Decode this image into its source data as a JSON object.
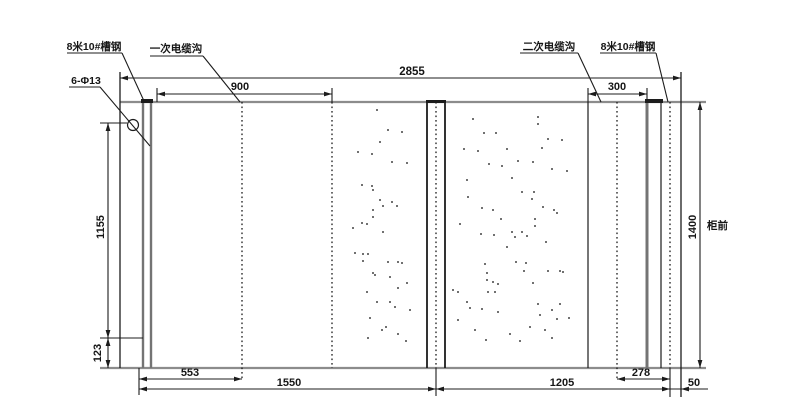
{
  "callouts": {
    "channel_steel_left": "8米10#槽钢",
    "primary_cable_trench": "一次电缆沟",
    "secondary_cable_trench": "二次电缆沟",
    "channel_steel_right": "8米10#槽钢",
    "bolt_holes": "6-Φ13",
    "cabinet_front": "柜前"
  },
  "dimensions": {
    "overall_width": "2855",
    "primary_trench_offset": "900",
    "secondary_trench_width": "300",
    "hole_span_vertical": "1155",
    "hole_to_bottom_edge": "123",
    "foundation_depth": "1400",
    "rail_to_primary_trench": "553",
    "left_section_width": "1550",
    "right_section_width": "1205",
    "trench_to_rail_right": "278",
    "rail_to_right_edge": "50"
  },
  "colors": {
    "line": "#1c1c1c",
    "edge": "#8c8c8c",
    "steel": "#747474",
    "text": "#161616",
    "background": "#ffffff"
  },
  "geometry": {
    "borders": [
      [
        120,
        102,
        706,
        102,
        "edge"
      ],
      [
        100,
        368,
        706,
        368,
        "edge"
      ],
      [
        120,
        72,
        120,
        368,
        "ln"
      ],
      [
        681,
        72,
        681,
        397,
        "ln"
      ]
    ],
    "steel_lines": [
      [
        143,
        102,
        143,
        368,
        2.4
      ],
      [
        151,
        102,
        151,
        368,
        2.4
      ],
      [
        647,
        102,
        647,
        368,
        3.0
      ]
    ],
    "solid_lines": [
      [
        427,
        102,
        427,
        368,
        1.8
      ],
      [
        445,
        102,
        445,
        368,
        1.8
      ],
      [
        588,
        102,
        588,
        368,
        1.2
      ],
      [
        661,
        102,
        661,
        368,
        1.2
      ]
    ],
    "dotted_lines": [
      [
        242,
        102,
        242,
        381
      ],
      [
        332,
        102,
        332,
        368
      ],
      [
        436,
        102,
        436,
        368
      ],
      [
        617,
        102,
        617,
        381
      ],
      [
        670,
        102,
        670,
        368
      ]
    ],
    "ext_lines": [
      [
        157,
        88,
        157,
        102
      ],
      [
        332,
        88,
        332,
        102
      ],
      [
        588,
        88,
        588,
        102
      ],
      [
        647,
        88,
        647,
        102
      ],
      [
        100,
        123,
        127,
        123
      ],
      [
        100,
        338,
        143,
        338
      ],
      [
        139,
        368,
        139,
        395
      ],
      [
        436,
        368,
        436,
        396
      ],
      [
        670,
        368,
        670,
        397
      ]
    ],
    "caps": [
      [
        141,
        99,
        12,
        4
      ],
      [
        645,
        99,
        18,
        4
      ],
      [
        426,
        100,
        20,
        3
      ]
    ],
    "hole": [
      133,
      125,
      5.5
    ],
    "underlines": [
      [
        67,
        53,
        122,
        53
      ],
      [
        150,
        56,
        203,
        56
      ],
      [
        520,
        53,
        578,
        53
      ],
      [
        600,
        53,
        656,
        53
      ],
      [
        69,
        87,
        100,
        87
      ]
    ],
    "leaders": [
      [
        122,
        53,
        144,
        101
      ],
      [
        203,
        56,
        240,
        102
      ],
      [
        578,
        53,
        601,
        102
      ],
      [
        656,
        53,
        668,
        102
      ],
      [
        100,
        87,
        150,
        146
      ]
    ],
    "dims_h": [
      [
        120,
        681,
        78
      ],
      [
        157,
        332,
        94
      ],
      [
        588,
        647,
        94
      ],
      [
        139,
        242,
        379
      ],
      [
        617,
        670,
        379
      ],
      [
        139,
        436,
        389
      ],
      [
        436,
        670,
        389
      ]
    ],
    "dim_small": {
      "x1": 670,
      "x2": 681,
      "y": 389,
      "tail": 708
    },
    "dims_v": [
      [
        123,
        338,
        108
      ],
      [
        338,
        368,
        108
      ],
      [
        102,
        368,
        700
      ]
    ],
    "stipple": [
      [
        377,
        110
      ],
      [
        388,
        130
      ],
      [
        402,
        132
      ],
      [
        380,
        142
      ],
      [
        358,
        152
      ],
      [
        372,
        154
      ],
      [
        392,
        162
      ],
      [
        407,
        163
      ],
      [
        362,
        185
      ],
      [
        372,
        186
      ],
      [
        373,
        190
      ],
      [
        380,
        200
      ],
      [
        383,
        206
      ],
      [
        392,
        202
      ],
      [
        397,
        206
      ],
      [
        373,
        210
      ],
      [
        373,
        217
      ],
      [
        362,
        223
      ],
      [
        367,
        224
      ],
      [
        353,
        228
      ],
      [
        383,
        232
      ],
      [
        355,
        253
      ],
      [
        363,
        254
      ],
      [
        368,
        254
      ],
      [
        363,
        261
      ],
      [
        388,
        262
      ],
      [
        398,
        262
      ],
      [
        402,
        263
      ],
      [
        373,
        273
      ],
      [
        375,
        275
      ],
      [
        390,
        277
      ],
      [
        407,
        283
      ],
      [
        398,
        288
      ],
      [
        367,
        292
      ],
      [
        377,
        302
      ],
      [
        390,
        302
      ],
      [
        395,
        307
      ],
      [
        410,
        310
      ],
      [
        370,
        318
      ],
      [
        382,
        330
      ],
      [
        398,
        334
      ],
      [
        406,
        341
      ],
      [
        368,
        338
      ],
      [
        386,
        327
      ],
      [
        473,
        119
      ],
      [
        538,
        117
      ],
      [
        538,
        124
      ],
      [
        484,
        133
      ],
      [
        496,
        133
      ],
      [
        548,
        139
      ],
      [
        562,
        140
      ],
      [
        464,
        149
      ],
      [
        478,
        151
      ],
      [
        507,
        149
      ],
      [
        542,
        148
      ],
      [
        489,
        164
      ],
      [
        502,
        166
      ],
      [
        518,
        161
      ],
      [
        533,
        162
      ],
      [
        552,
        169
      ],
      [
        567,
        171
      ],
      [
        512,
        178
      ],
      [
        467,
        180
      ],
      [
        468,
        197
      ],
      [
        522,
        192
      ],
      [
        532,
        199
      ],
      [
        534,
        192
      ],
      [
        482,
        208
      ],
      [
        493,
        210
      ],
      [
        543,
        207
      ],
      [
        554,
        210
      ],
      [
        557,
        213
      ],
      [
        501,
        219
      ],
      [
        535,
        219
      ],
      [
        535,
        226
      ],
      [
        460,
        224
      ],
      [
        481,
        234
      ],
      [
        494,
        235
      ],
      [
        512,
        232
      ],
      [
        515,
        237
      ],
      [
        522,
        232
      ],
      [
        527,
        236
      ],
      [
        507,
        247
      ],
      [
        546,
        242
      ],
      [
        516,
        262
      ],
      [
        526,
        263
      ],
      [
        524,
        271
      ],
      [
        533,
        283
      ],
      [
        548,
        271
      ],
      [
        560,
        271
      ],
      [
        563,
        272
      ],
      [
        485,
        264
      ],
      [
        487,
        273
      ],
      [
        487,
        280
      ],
      [
        493,
        282
      ],
      [
        498,
        284
      ],
      [
        453,
        290
      ],
      [
        458,
        292
      ],
      [
        488,
        292
      ],
      [
        495,
        292
      ],
      [
        467,
        302
      ],
      [
        470,
        308
      ],
      [
        482,
        309
      ],
      [
        498,
        312
      ],
      [
        538,
        304
      ],
      [
        552,
        310
      ],
      [
        560,
        304
      ],
      [
        540,
        315
      ],
      [
        557,
        319
      ],
      [
        569,
        318
      ],
      [
        458,
        320
      ],
      [
        530,
        327
      ],
      [
        475,
        330
      ],
      [
        510,
        334
      ],
      [
        545,
        330
      ],
      [
        520,
        341
      ],
      [
        486,
        340
      ],
      [
        552,
        338
      ]
    ]
  }
}
